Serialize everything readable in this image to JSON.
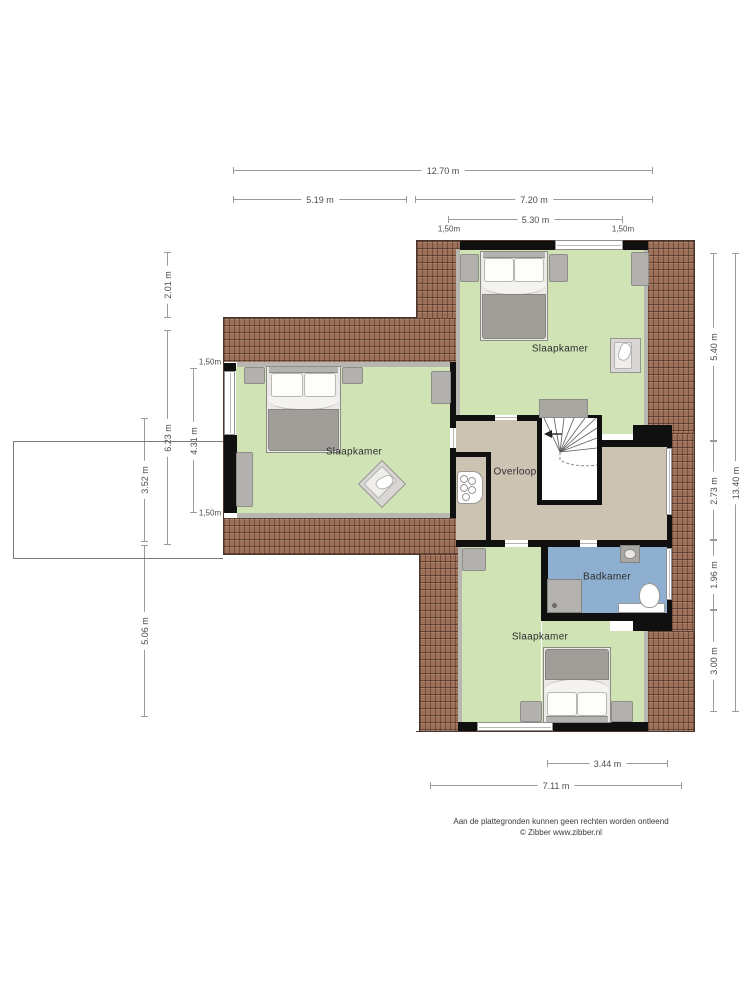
{
  "rooms": {
    "bedroom_top": "Slaapkamer",
    "bedroom_left": "Slaapkamer",
    "bedroom_bottom": "Slaapkamer",
    "landing": "Overloop",
    "bathroom": "Badkamer"
  },
  "dims": {
    "top_total": "12.70 m",
    "top_left": "5.19 m",
    "top_right": "7.20 m",
    "top_inner": "5.30 m",
    "top_eave_left": "1,50m",
    "top_eave_right": "1,50m",
    "left_upper": "2.01 m",
    "left_wing": "6.23 m",
    "left_inner": "4.31 m",
    "left_eave_top": "1,50m",
    "left_eave_bottom": "1,50m",
    "left_annex": "3.52 m",
    "left_lower": "5.06 m",
    "right_top": "5.40 m",
    "right_mid": "2.73 m",
    "right_bath": "1.96 m",
    "right_bottom": "3.00 m",
    "right_total": "13.40 m",
    "bottom_inner": "3.44 m",
    "bottom_total": "7.11 m"
  },
  "footer": {
    "line1": "Aan de plattegronden kunnen geen rechten worden ontleend",
    "line2": "© Zibber www.zibber.nl"
  },
  "colors": {
    "floor_room": "#cfe3b5",
    "floor_hall": "#cdc3b2",
    "floor_bath": "#8fafd0",
    "roof": "#9c7059",
    "wall": "#101010"
  }
}
